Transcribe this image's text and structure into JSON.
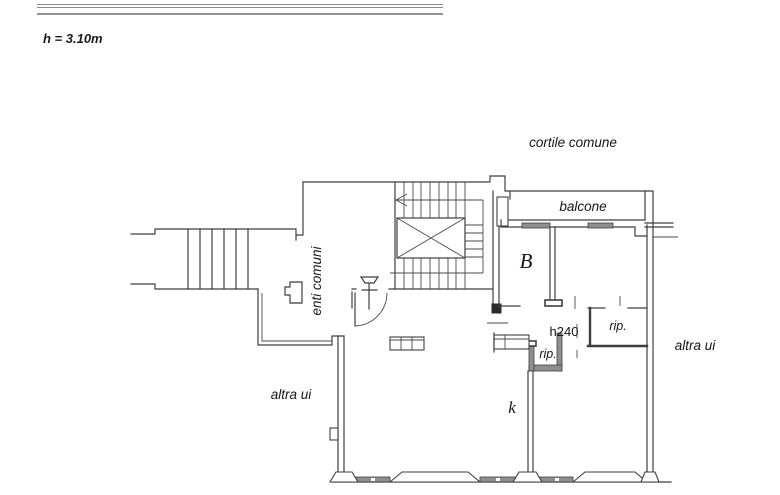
{
  "header": {
    "height_note": "h = 3.10m",
    "rule_color": "#8a8a8a"
  },
  "plan": {
    "labels": {
      "courtyard": "cortile comune",
      "balcony": "balcone",
      "room_b": "B",
      "common_areas": "enti comuni",
      "height_240": "h240",
      "closet_right": "rip.",
      "closet_bottom": "rip.",
      "other_unit_right": "altra ui",
      "other_unit_left": "altra ui",
      "kitchen": "k"
    },
    "colors": {
      "wall": "#3f3f3f",
      "poche": "#8f8f8f",
      "text": "#161616",
      "background": "#ffffff"
    }
  }
}
